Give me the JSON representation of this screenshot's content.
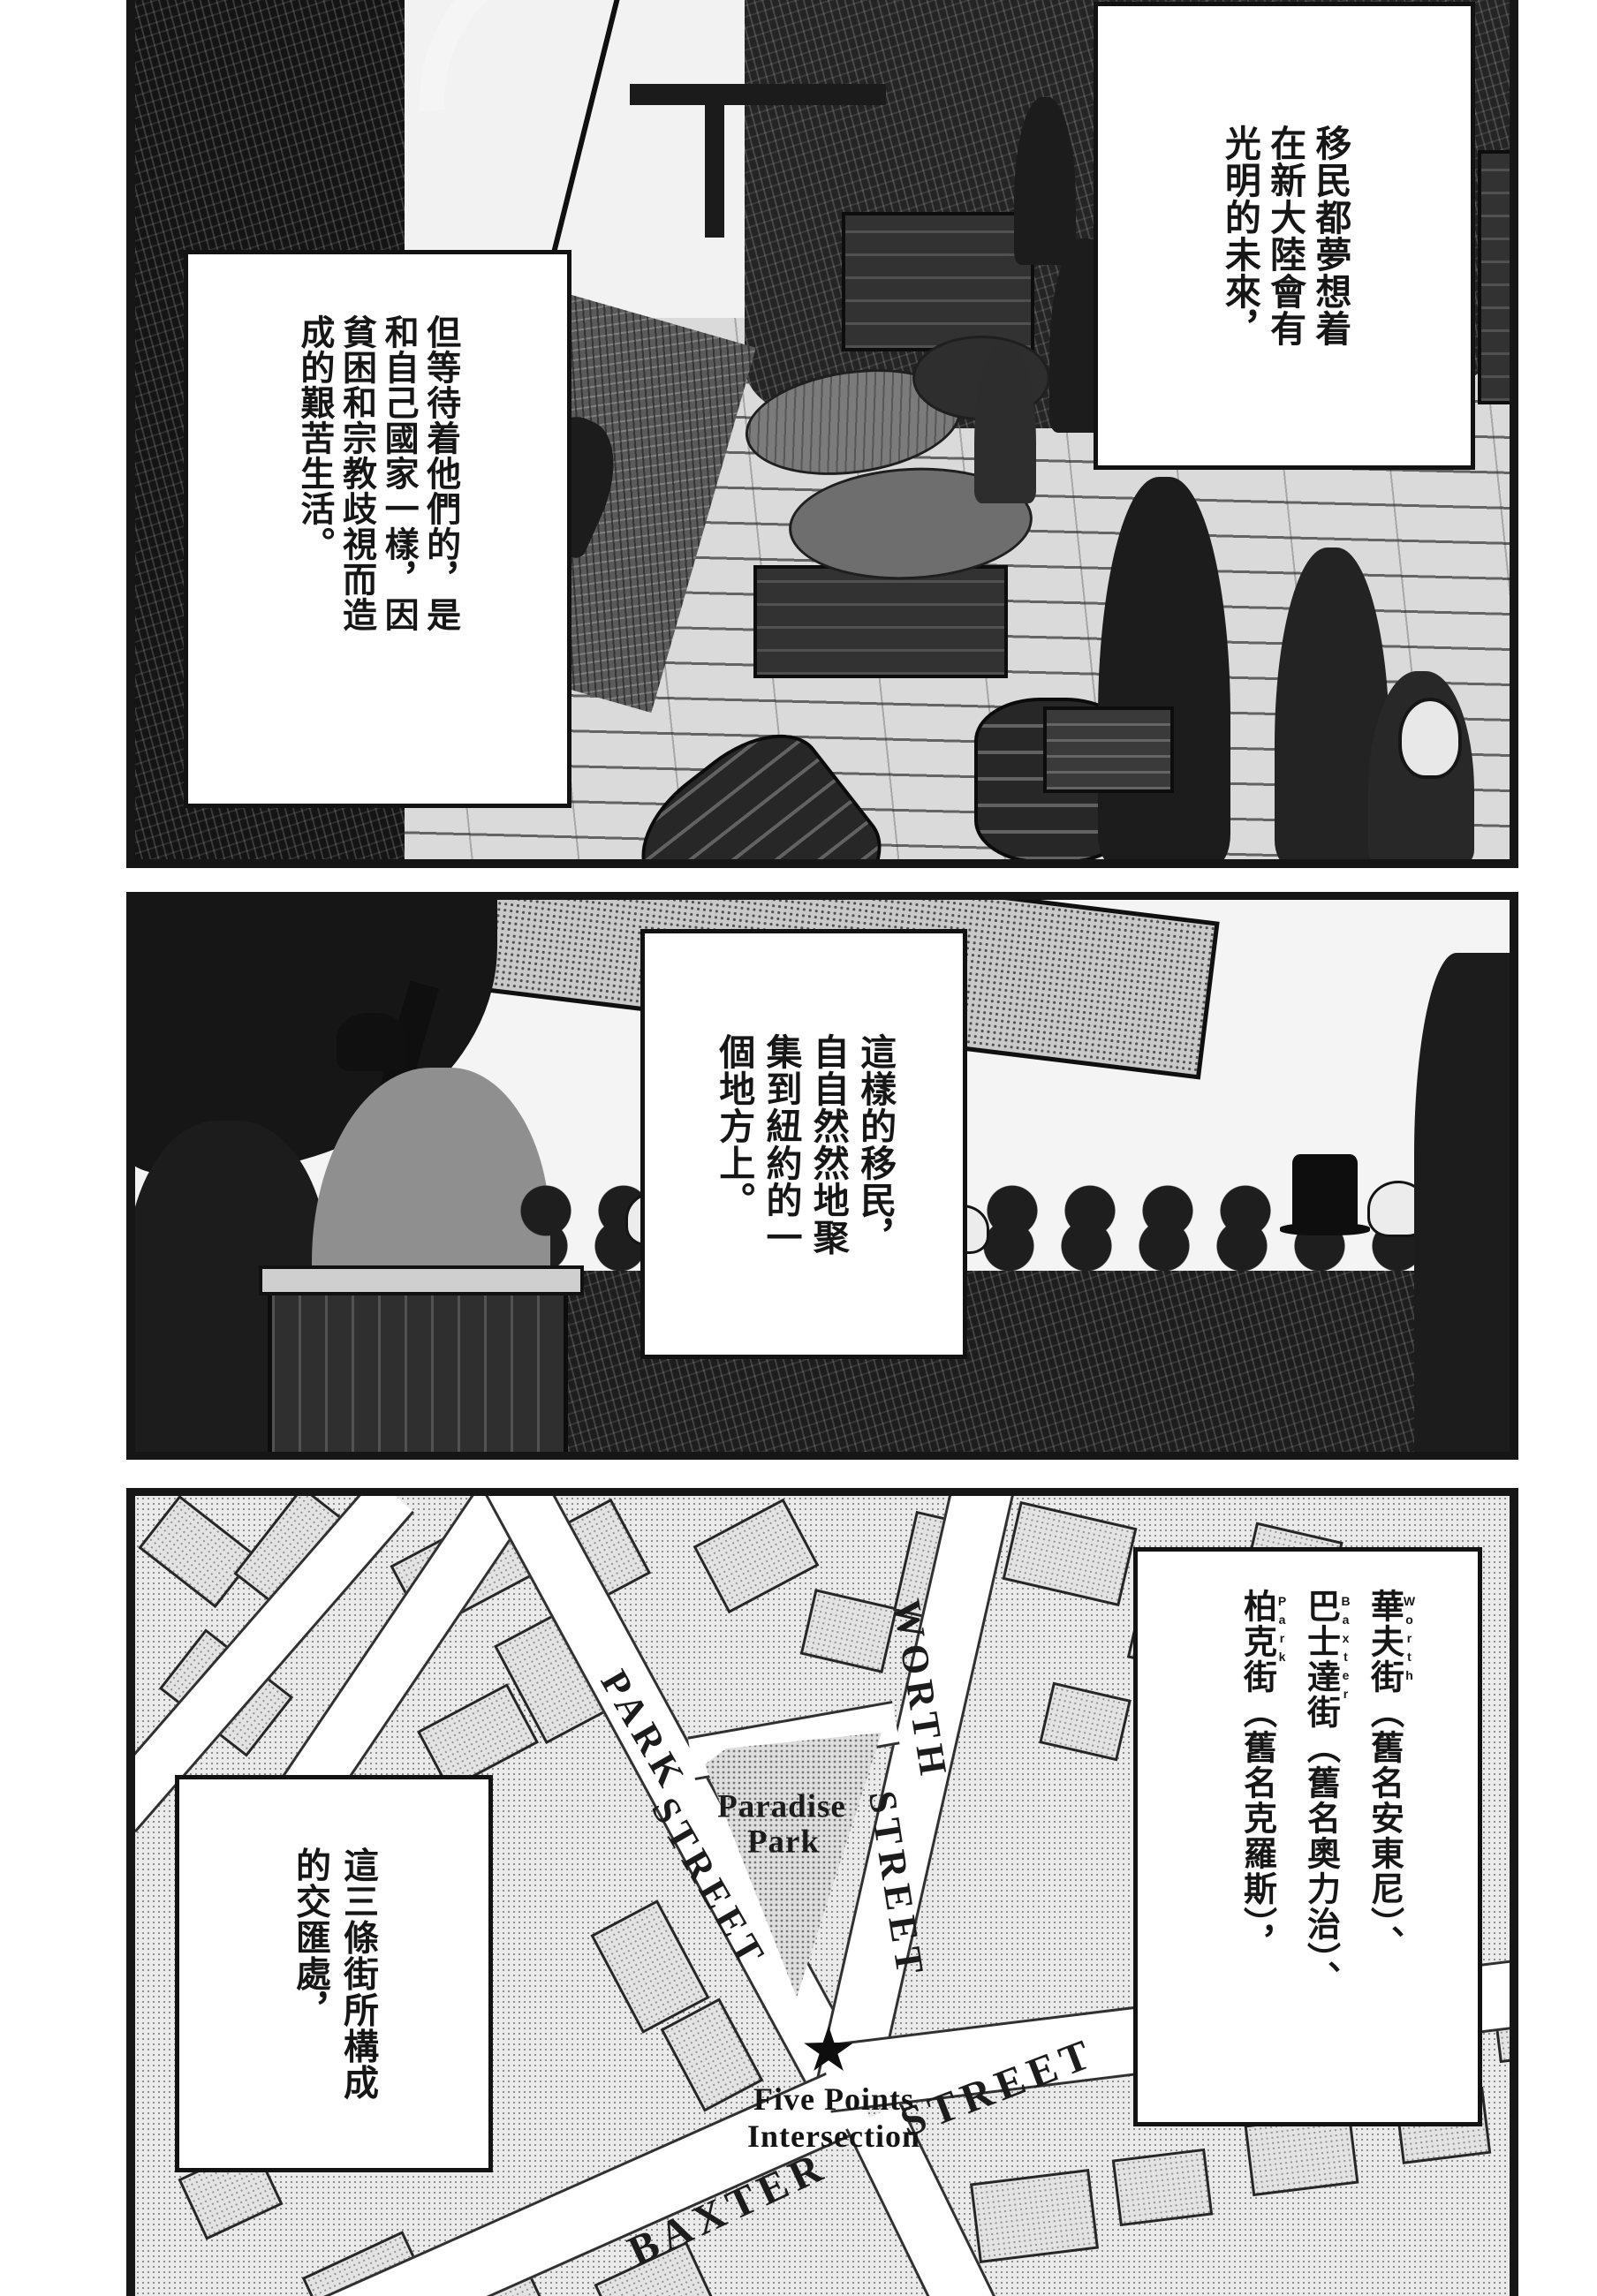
{
  "page": {
    "kind": "manga page",
    "ink_color": "#161616",
    "paper_color": "#ffffff"
  },
  "panel1": {
    "balloon_right": {
      "columns": [
        "移民都夢想着",
        "在新大陸會有",
        "光明的未來，"
      ]
    },
    "balloon_left": {
      "columns": [
        "但等待着他們的，是",
        "和自己國家一樣，因",
        "貧困和宗教歧視而造",
        "成的艱苦生活。"
      ]
    }
  },
  "panel2": {
    "balloon": {
      "columns": [
        "這樣的移民，",
        "自自然然地聚",
        "集到紐約的一",
        "個地方上。"
      ]
    }
  },
  "panel3": {
    "balloon_streets": {
      "columns": [
        {
          "ruby": "Worth",
          "text": "華夫街（舊名安東尼）、"
        },
        {
          "ruby": "Baxter",
          "text": "巴士達街（舊名奧力治）、"
        },
        {
          "ruby": "Park",
          "text": "柏克街（舊名克羅斯），"
        }
      ]
    },
    "balloon_intersection": {
      "columns": [
        "這三條街所構成",
        "的交匯處，"
      ]
    },
    "map": {
      "labels": {
        "park_street": {
          "w1": "PARK",
          "w2": "STREET"
        },
        "worth_street": {
          "w1": "WORTH",
          "w2": "STREET"
        },
        "baxter_street": {
          "w1": "BAXTER",
          "w2": "STREET"
        },
        "paradise_park": {
          "l1": "Paradise",
          "l2": "Park"
        },
        "five_points": {
          "l1": "Five Points",
          "l2": "Intersection"
        }
      },
      "star_icon": "five-points-star"
    }
  }
}
